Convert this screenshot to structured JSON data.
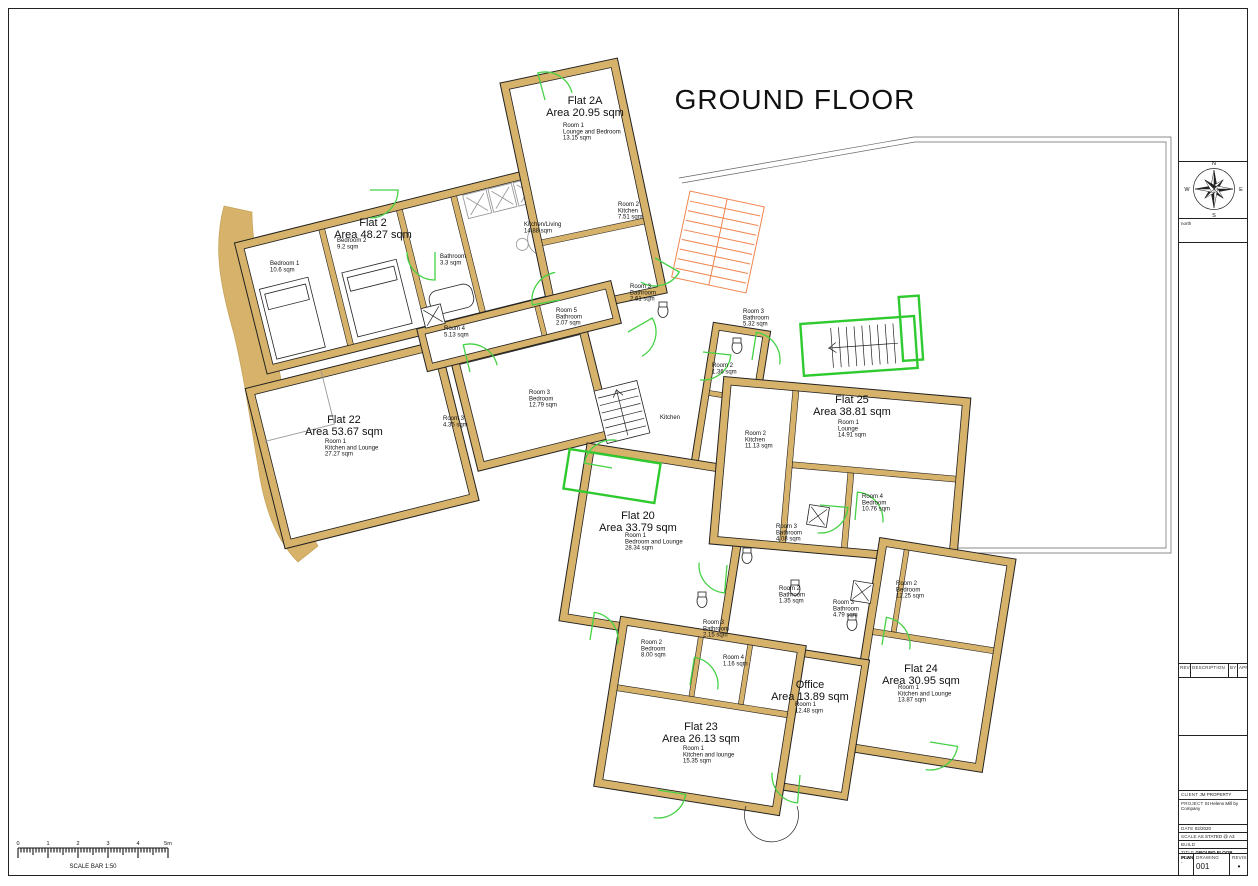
{
  "title": "GROUND FLOOR",
  "compass": {
    "n": "N",
    "e": "E",
    "s": "S",
    "w": "W",
    "caption": "north"
  },
  "scale_bar": {
    "numbers": [
      "0",
      "1",
      "2",
      "3",
      "4",
      "5m"
    ],
    "caption": "SCALE BAR 1:50"
  },
  "title_block": {
    "rev": "REV.",
    "description": "DESCRIPTION",
    "by": "BY",
    "app": "APP",
    "client_label": "CLIENT",
    "client": "JM PROPERTY",
    "project_label": "PROJECT",
    "project": "St Helens Mill by Company",
    "date_label": "DATE",
    "date": "02/2020",
    "scale_label": "SCALE",
    "scale": "AS STATED @ A3",
    "build_label": "BUILD",
    "title_label": "TITLE",
    "title": "GROUND FLOOR PLAN",
    "job_label": "JOB",
    "job": "-",
    "drawing_label": "DRAWING",
    "drawing": "001",
    "revision_label": "REVISION",
    "revision": "•"
  },
  "colors": {
    "wall": "#d6b26a",
    "door_arc": "#44d144",
    "green_zone": "#2fca2f",
    "stair_orange": "#f0854f",
    "line": "#222222"
  },
  "plan": {
    "flats": [
      {
        "name": "Flat 2",
        "area": "Area 48.27 sqm",
        "x": 373,
        "y": 226,
        "rooms": [
          {
            "x": 270,
            "y": 265,
            "lines": [
              "Bedroom 1",
              "10.6 sqm"
            ]
          },
          {
            "x": 337,
            "y": 242,
            "lines": [
              "Bedroom 2",
              "9.2 sqm"
            ]
          },
          {
            "x": 440,
            "y": 258,
            "lines": [
              "Bathroom",
              "3.3 sqm"
            ]
          },
          {
            "x": 524,
            "y": 226,
            "lines": [
              "Kitchen/Living",
              "14.88 sqm"
            ]
          }
        ]
      },
      {
        "name": "Flat 2A",
        "area": "Area 20.95 sqm",
        "x": 585,
        "y": 104,
        "rooms": [
          {
            "x": 563,
            "y": 127,
            "lines": [
              "Room 1",
              "Lounge and Bedroom",
              "13.15 sqm"
            ]
          },
          {
            "x": 618,
            "y": 206,
            "lines": [
              "Room 2",
              "Kitchen",
              "7.51 sqm"
            ]
          }
        ]
      },
      {
        "name": "Flat 22",
        "area": "Area 53.67 sqm",
        "x": 344,
        "y": 423,
        "rooms": [
          {
            "x": 325,
            "y": 443,
            "lines": [
              "Room 1",
              "Kitchen and Lounge",
              "27.27 sqm"
            ]
          },
          {
            "x": 443,
            "y": 420,
            "lines": [
              "Room 3",
              "4.35 sqm"
            ]
          }
        ]
      },
      {
        "name": "Flat 20",
        "area": "Area 33.79 sqm",
        "x": 638,
        "y": 519,
        "rooms": [
          {
            "x": 625,
            "y": 537,
            "lines": [
              "Room 1",
              "Bedroom and Lounge",
              "28.34 sqm"
            ]
          }
        ]
      },
      {
        "name": "Flat 25",
        "area": "Area 38.81 sqm",
        "x": 852,
        "y": 403,
        "rooms": [
          {
            "x": 838,
            "y": 424,
            "lines": [
              "Room 1",
              "Lounge",
              "14.91 sqm"
            ]
          },
          {
            "x": 745,
            "y": 435,
            "lines": [
              "Room 2",
              "Kitchen",
              "11.13 sqm"
            ]
          },
          {
            "x": 862,
            "y": 498,
            "lines": [
              "Room 4",
              "Bedroom",
              "10.76 sqm"
            ]
          },
          {
            "x": 776,
            "y": 528,
            "lines": [
              "Room 3",
              "Bathroom",
              "4.08 sqm"
            ]
          }
        ]
      },
      {
        "name": "Flat 24",
        "area": "Area 30.95 sqm",
        "x": 921,
        "y": 672,
        "rooms": [
          {
            "x": 898,
            "y": 689,
            "lines": [
              "Room 1",
              "Kitchen and Lounge",
              "13.87 sqm"
            ]
          },
          {
            "x": 896,
            "y": 585,
            "lines": [
              "Room 2",
              "Bedroom",
              "12.25 sqm"
            ]
          },
          {
            "x": 833,
            "y": 604,
            "lines": [
              "Room 3",
              "Bathroom",
              "4.79 sqm"
            ]
          },
          {
            "x": 779,
            "y": 590,
            "lines": [
              "Room 2",
              "Bathroom",
              "1.35 sqm"
            ]
          }
        ]
      },
      {
        "name": "Flat 23",
        "area": "Area 26.13 sqm",
        "x": 701,
        "y": 730,
        "rooms": [
          {
            "x": 683,
            "y": 750,
            "lines": [
              "Room 1",
              "Kitchen and lounge",
              "15.35 sqm"
            ]
          },
          {
            "x": 641,
            "y": 644,
            "lines": [
              "Room 2",
              "Bedroom",
              "8.00 sqm"
            ]
          },
          {
            "x": 723,
            "y": 659,
            "lines": [
              "Room 4",
              "1.16 sqm"
            ]
          },
          {
            "x": 703,
            "y": 624,
            "lines": [
              "Room 3",
              "Bathroom",
              "2.15 sqm"
            ]
          }
        ]
      },
      {
        "name": "Office",
        "area": "Area 13.89 sqm",
        "x": 810,
        "y": 688,
        "rooms": [
          {
            "x": 795,
            "y": 706,
            "lines": [
              "Room 1",
              "12.48 sqm"
            ]
          }
        ]
      },
      {
        "name": "",
        "area": "",
        "x": 0,
        "y": 0,
        "rooms": [
          {
            "x": 529,
            "y": 394,
            "lines": [
              "Room 3",
              "Bedroom",
              "12.79 sqm"
            ]
          },
          {
            "x": 444,
            "y": 330,
            "lines": [
              "Room 4",
              "5.13 sqm"
            ]
          },
          {
            "x": 556,
            "y": 312,
            "lines": [
              "Room 5",
              "Bathroom",
              "2.07 sqm"
            ]
          },
          {
            "x": 630,
            "y": 288,
            "lines": [
              "Room 3",
              "Bathroom",
              "2.61 sqm"
            ]
          },
          {
            "x": 743,
            "y": 313,
            "lines": [
              "Room 3",
              "Bathroom",
              "5.32 sqm"
            ]
          },
          {
            "x": 712,
            "y": 367,
            "lines": [
              "Room 2",
              "1.36 sqm"
            ]
          },
          {
            "x": 660,
            "y": 419,
            "lines": [
              "Kitchen"
            ]
          }
        ]
      }
    ]
  }
}
